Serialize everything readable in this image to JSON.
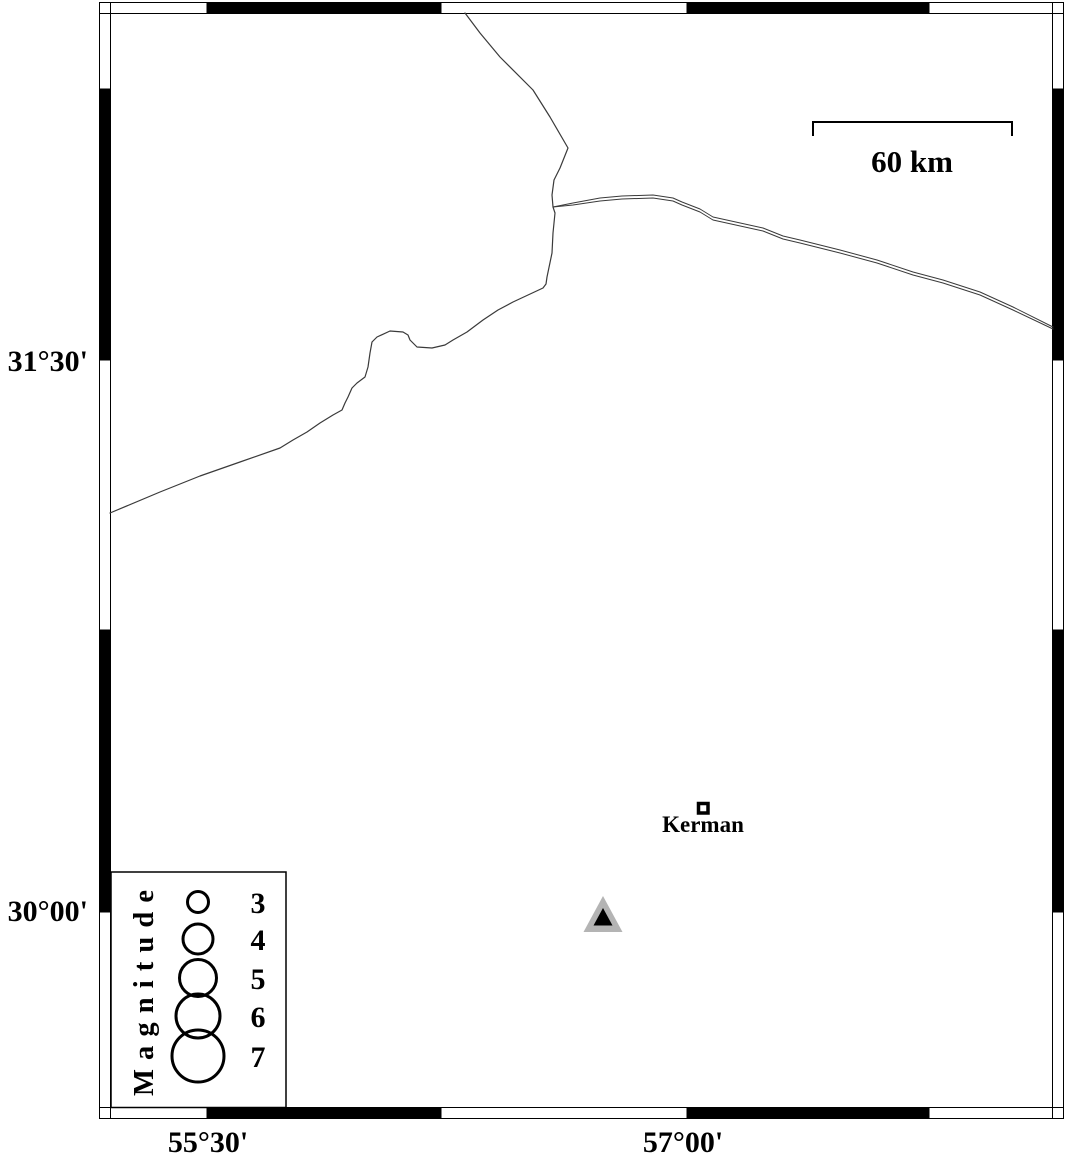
{
  "map": {
    "axis": {
      "left_labels": [
        "31°30'",
        "30°00'"
      ],
      "bottom_labels": [
        "55°30'",
        "57°00'"
      ]
    },
    "scale_bar": {
      "label": "60 km"
    },
    "city": {
      "label": "Kerman",
      "marker": "open-square"
    },
    "station": {
      "marker": "filled-triangle",
      "fill": "#b4b4b4",
      "inner_fill": "#000000"
    },
    "legend": {
      "title": "M a g n i t u d e",
      "items": [
        {
          "label": "3",
          "r": 10.5
        },
        {
          "label": "4",
          "r": 15
        },
        {
          "label": "5",
          "r": 18.5
        },
        {
          "label": "6",
          "r": 22
        },
        {
          "label": "7",
          "r": 26
        }
      ]
    },
    "lines": {
      "color": "#3a3a3a",
      "main_points": "465,13 480,33 500,57 533,90 550,117 568,148 560,168 554,180 552,195 553,207 555,213 553,233 552,253 547,277 546,284 543,288 528,295 513,302 498,310 483,320 467,332 453,340 445,345 432,348 417,347 410,340 408,335 403,332 390,331 377,337 372,342 370,353 368,367 365,377 357,383 352,388 348,397 345,403 342,410 333,415 320,423 307,432 293,440 280,448 240,462 200,476 160,492 110,513",
      "road_upper_points": "553,207 573,203 600,198 622,196 653,195 673,198 682,202 700,209 713,217 763,228 783,236 800,240 840,250 877,260 913,272 943,280 980,292 1013,307 1053,327",
      "road_lower_points": "553,207 573,205 600,201 622,199 653,198 673,201 682,205 700,212 713,220 763,231 783,239 800,243 840,253 877,263 913,275 943,283 980,295 1013,310 1053,329"
    }
  }
}
